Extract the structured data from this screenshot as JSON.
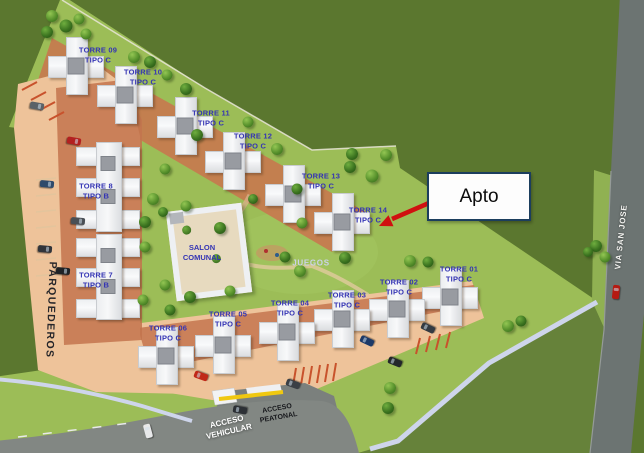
{
  "annotation": {
    "label": "Apto"
  },
  "area_labels": {
    "parqueaderos": "PARQUEDEROS",
    "via_san_jose": "VIA SAN JOSE",
    "acceso_vehicular_1": "ACCESO",
    "acceso_vehicular_2": "VEHICULAR",
    "acceso_peatonal_1": "ACCESO",
    "acceso_peatonal_2": "PEATONAL",
    "salon_comunal_1": "SALON",
    "salon_comunal_2": "COMUNAL",
    "juegos": "JUEGOS"
  },
  "towers": [
    {
      "name": "TORRE 09",
      "tipo": "TIPO C",
      "type": "C",
      "bx": 48,
      "by": 37,
      "lx": 98,
      "ly": 55
    },
    {
      "name": "TORRE 10",
      "tipo": "TIPO C",
      "type": "C",
      "bx": 97,
      "by": 66,
      "lx": 143,
      "ly": 77
    },
    {
      "name": "TORRE 11",
      "tipo": "TIPO C",
      "type": "C",
      "bx": 157,
      "by": 97,
      "lx": 211,
      "ly": 118
    },
    {
      "name": "TORRE 12",
      "tipo": "TIPO C",
      "type": "C",
      "bx": 205,
      "by": 132,
      "lx": 253,
      "ly": 141
    },
    {
      "name": "TORRE 13",
      "tipo": "TIPO C",
      "type": "C",
      "bx": 265,
      "by": 165,
      "lx": 321,
      "ly": 181
    },
    {
      "name": "TORRE 14",
      "tipo": "TIPO C",
      "type": "C",
      "bx": 314,
      "by": 193,
      "lx": 368,
      "ly": 215
    },
    {
      "name": "TORRE 8",
      "tipo": "TIPO B",
      "type": "B",
      "bx": 76,
      "by": 142,
      "bw": 64,
      "bh": 90,
      "lx": 96,
      "ly": 191
    },
    {
      "name": "TORRE 7",
      "tipo": "TIPO B",
      "type": "B",
      "bx": 76,
      "by": 234,
      "bw": 64,
      "bh": 86,
      "lx": 96,
      "ly": 280
    },
    {
      "name": "TORRE 01",
      "tipo": "TIPO C",
      "type": "C",
      "bx": 422,
      "by": 268,
      "lx": 459,
      "ly": 274
    },
    {
      "name": "TORRE 02",
      "tipo": "TIPO C",
      "type": "C",
      "bx": 369,
      "by": 280,
      "lx": 399,
      "ly": 287
    },
    {
      "name": "TORRE 03",
      "tipo": "TIPO C",
      "type": "C",
      "bx": 314,
      "by": 290,
      "lx": 347,
      "ly": 300
    },
    {
      "name": "TORRE 04",
      "tipo": "TIPO C",
      "type": "C",
      "bx": 259,
      "by": 303,
      "lx": 290,
      "ly": 308
    },
    {
      "name": "TORRE 05",
      "tipo": "TIPO C",
      "type": "C",
      "bx": 195,
      "by": 316,
      "lx": 228,
      "ly": 319
    },
    {
      "name": "TORRE 06",
      "tipo": "TIPO C",
      "type": "C",
      "bx": 138,
      "by": 327,
      "lx": 168,
      "ly": 333
    }
  ],
  "scene": {
    "trees": [
      [
        52,
        16,
        12,
        0
      ],
      [
        66,
        26,
        13,
        1
      ],
      [
        79,
        19,
        11,
        0
      ],
      [
        47,
        32,
        12,
        1
      ],
      [
        86,
        34,
        11,
        0
      ],
      [
        134,
        57,
        12,
        0
      ],
      [
        150,
        62,
        12,
        1
      ],
      [
        167,
        75,
        11,
        0
      ],
      [
        186,
        89,
        12,
        1
      ],
      [
        165,
        169,
        11,
        0
      ],
      [
        197,
        135,
        12,
        1
      ],
      [
        248,
        122,
        11,
        0
      ],
      [
        277,
        149,
        12,
        0
      ],
      [
        352,
        154,
        12,
        1
      ],
      [
        386,
        155,
        12,
        0
      ],
      [
        350,
        167,
        12,
        1
      ],
      [
        372,
        176,
        13,
        0
      ],
      [
        297,
        189,
        11,
        1
      ],
      [
        153,
        199,
        12,
        0
      ],
      [
        145,
        222,
        12,
        1
      ],
      [
        145,
        247,
        11,
        0
      ],
      [
        163,
        212,
        10,
        1
      ],
      [
        186,
        206,
        11,
        0
      ],
      [
        220,
        228,
        12,
        1
      ],
      [
        165,
        285,
        11,
        0
      ],
      [
        190,
        297,
        12,
        1
      ],
      [
        230,
        291,
        11,
        0
      ],
      [
        253,
        199,
        10,
        1
      ],
      [
        302,
        223,
        11,
        0
      ],
      [
        285,
        257,
        11,
        1
      ],
      [
        300,
        271,
        12,
        0
      ],
      [
        345,
        258,
        12,
        1
      ],
      [
        410,
        261,
        12,
        0
      ],
      [
        428,
        262,
        11,
        1
      ],
      [
        508,
        326,
        12,
        0
      ],
      [
        521,
        321,
        11,
        1
      ],
      [
        596,
        246,
        12,
        1
      ],
      [
        605,
        257,
        11,
        0
      ],
      [
        588,
        252,
        10,
        1
      ],
      [
        390,
        388,
        12,
        0
      ],
      [
        388,
        408,
        12,
        1
      ],
      [
        143,
        300,
        11,
        0
      ],
      [
        170,
        310,
        11,
        1
      ]
    ],
    "cars": [
      {
        "x": 37,
        "y": 106,
        "c": "#5a6268",
        "r": 100
      },
      {
        "x": 74,
        "y": 141,
        "c": "#b32020",
        "r": 100
      },
      {
        "x": 47,
        "y": 184,
        "c": "#2e4a6b",
        "r": 95
      },
      {
        "x": 78,
        "y": 221,
        "c": "#4a4f55",
        "r": 95
      },
      {
        "x": 45,
        "y": 249,
        "c": "#30343a",
        "r": 95
      },
      {
        "x": 63,
        "y": 271,
        "c": "#1e2226",
        "r": 95
      },
      {
        "x": 201,
        "y": 376,
        "c": "#c02818",
        "r": -70
      },
      {
        "x": 293,
        "y": 384,
        "c": "#3a3f45",
        "r": -70
      },
      {
        "x": 367,
        "y": 341,
        "c": "#1d3a68",
        "r": -65
      },
      {
        "x": 428,
        "y": 328,
        "c": "#343a42",
        "r": -65
      },
      {
        "x": 395,
        "y": 362,
        "c": "#23262b",
        "r": -68
      },
      {
        "x": 616,
        "y": 292,
        "c": "#b51a12",
        "r": 6
      },
      {
        "x": 148,
        "y": 431,
        "c": "#e8e9ea",
        "r": -15
      },
      {
        "x": 240,
        "y": 410,
        "c": "#2c3035",
        "r": -80
      }
    ]
  },
  "colors": {
    "field_dark": "#5b772f",
    "field_bottom": "#66823a",
    "estate_lawn": "#9cbd57",
    "road": "#6c7472",
    "road_bottom": "#828783",
    "sidewalk": "#ced5eb",
    "parking_tan": "#eec39a",
    "brick": "#c3744d",
    "stripe": "#c8522c",
    "label_blue": "#3434b4",
    "arrow_red": "#d01010",
    "box_border": "#1c3e5e",
    "gate_yellow": "#f0c810"
  }
}
